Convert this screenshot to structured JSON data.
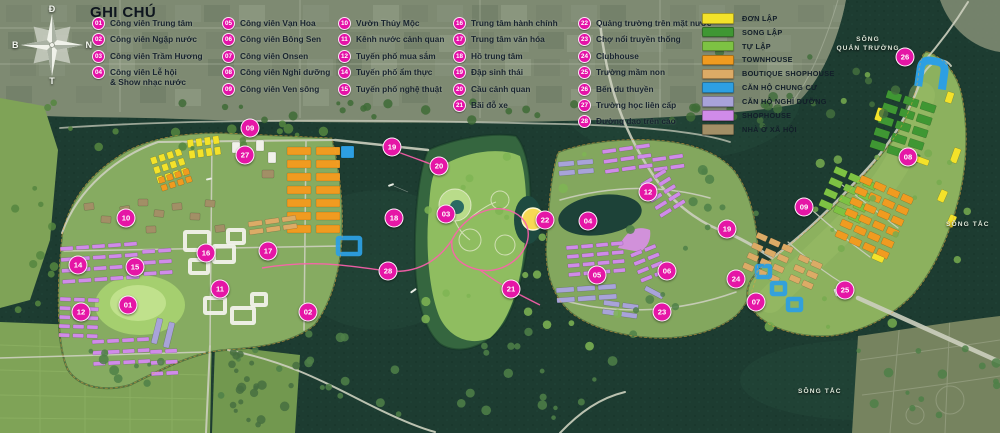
{
  "legend": {
    "title": "GHI CHÚ",
    "columns": [
      [
        {
          "num": "01",
          "label": "Công viên Trung tâm"
        },
        {
          "num": "02",
          "label": "Công viên Ngập nước"
        },
        {
          "num": "03",
          "label": "Công viên Trầm Hương"
        },
        {
          "num": "04",
          "label": "Công viên Lễ hội\n& Show nhạc nước"
        }
      ],
      [
        {
          "num": "05",
          "label": "Công viên Vạn Hoa"
        },
        {
          "num": "06",
          "label": "Công viên Bông Sen"
        },
        {
          "num": "07",
          "label": "Công viên Onsen"
        },
        {
          "num": "08",
          "label": "Công viên Nghỉ dưỡng"
        },
        {
          "num": "09",
          "label": "Công viên Ven sông"
        }
      ],
      [
        {
          "num": "10",
          "label": "Vườn Thủy Mộc"
        },
        {
          "num": "11",
          "label": "Kênh nước cảnh quan"
        },
        {
          "num": "12",
          "label": "Tuyến phố mua sắm"
        },
        {
          "num": "14",
          "label": "Tuyến phố ẩm thực"
        },
        {
          "num": "15",
          "label": "Tuyến phố nghệ thuật"
        }
      ],
      [
        {
          "num": "16",
          "label": "Trung tâm hành chính"
        },
        {
          "num": "17",
          "label": "Trung tâm văn hóa"
        },
        {
          "num": "18",
          "label": "Hồ trung tâm"
        },
        {
          "num": "19",
          "label": "Đập sinh thái"
        },
        {
          "num": "20",
          "label": "Cầu cảnh quan"
        },
        {
          "num": "21",
          "label": "Bãi đỗ xe"
        }
      ],
      [
        {
          "num": "22",
          "label": "Quảng trường trên mặt nước"
        },
        {
          "num": "23",
          "label": "Chợ nổi truyền thống"
        },
        {
          "num": "24",
          "label": "Clubhouse"
        },
        {
          "num": "25",
          "label": "Trường mầm non"
        },
        {
          "num": "26",
          "label": "Bến du thuyền"
        },
        {
          "num": "27",
          "label": "Trường học liên cấp"
        },
        {
          "num": "28",
          "label": "Đường dạo trên cao"
        }
      ]
    ]
  },
  "color_legend": [
    {
      "label": "ĐƠN LẬP",
      "color": "#f3e22a"
    },
    {
      "label": "SONG LẬP",
      "color": "#3f9733"
    },
    {
      "label": "TỰ LẬP",
      "color": "#7dc243"
    },
    {
      "label": "TOWNHOUSE",
      "color": "#f09b20"
    },
    {
      "label": "BOUTIQUE SHOPHOUSE",
      "color": "#dcab66"
    },
    {
      "label": "CĂN HỘ CHUNG CƯ",
      "color": "#2d9fe2"
    },
    {
      "label": "CĂN HỘ NGHỈ DƯỠNG",
      "color": "#a8a3d9"
    },
    {
      "label": "SHOPHOUSE",
      "color": "#d08be9"
    },
    {
      "label": "NHÀ Ở XÃ HỘI",
      "color": "#a28f66"
    }
  ],
  "compass": {
    "top": "Đ",
    "left": "B",
    "right": "N",
    "bottom": "T"
  },
  "map_labels": {
    "river_top_right": "SÔNG\nQUẢN TRƯỜNG",
    "river_right": "SÔNG TẮC",
    "river_bottom": "SÔNG TẮC"
  },
  "markers": [
    {
      "num": "09",
      "x": 250,
      "y": 128
    },
    {
      "num": "27",
      "x": 245,
      "y": 155
    },
    {
      "num": "10",
      "x": 126,
      "y": 218
    },
    {
      "num": "16",
      "x": 206,
      "y": 253
    },
    {
      "num": "17",
      "x": 268,
      "y": 251
    },
    {
      "num": "14",
      "x": 78,
      "y": 265
    },
    {
      "num": "15",
      "x": 135,
      "y": 267
    },
    {
      "num": "11",
      "x": 220,
      "y": 289
    },
    {
      "num": "01",
      "x": 128,
      "y": 305
    },
    {
      "num": "12",
      "x": 81,
      "y": 312
    },
    {
      "num": "02",
      "x": 308,
      "y": 312
    },
    {
      "num": "19",
      "x": 392,
      "y": 147
    },
    {
      "num": "20",
      "x": 439,
      "y": 166
    },
    {
      "num": "18",
      "x": 394,
      "y": 218
    },
    {
      "num": "03",
      "x": 446,
      "y": 214
    },
    {
      "num": "28",
      "x": 388,
      "y": 271
    },
    {
      "num": "22",
      "x": 545,
      "y": 220
    },
    {
      "num": "21",
      "x": 511,
      "y": 289
    },
    {
      "num": "04",
      "x": 588,
      "y": 221
    },
    {
      "num": "12",
      "x": 648,
      "y": 192
    },
    {
      "num": "05",
      "x": 597,
      "y": 275
    },
    {
      "num": "06",
      "x": 667,
      "y": 271
    },
    {
      "num": "23",
      "x": 662,
      "y": 312
    },
    {
      "num": "24",
      "x": 736,
      "y": 279
    },
    {
      "num": "07",
      "x": 756,
      "y": 302
    },
    {
      "num": "19",
      "x": 727,
      "y": 229
    },
    {
      "num": "09",
      "x": 804,
      "y": 207
    },
    {
      "num": "08",
      "x": 908,
      "y": 157
    },
    {
      "num": "25",
      "x": 845,
      "y": 290
    },
    {
      "num": "26",
      "x": 905,
      "y": 57
    }
  ]
}
